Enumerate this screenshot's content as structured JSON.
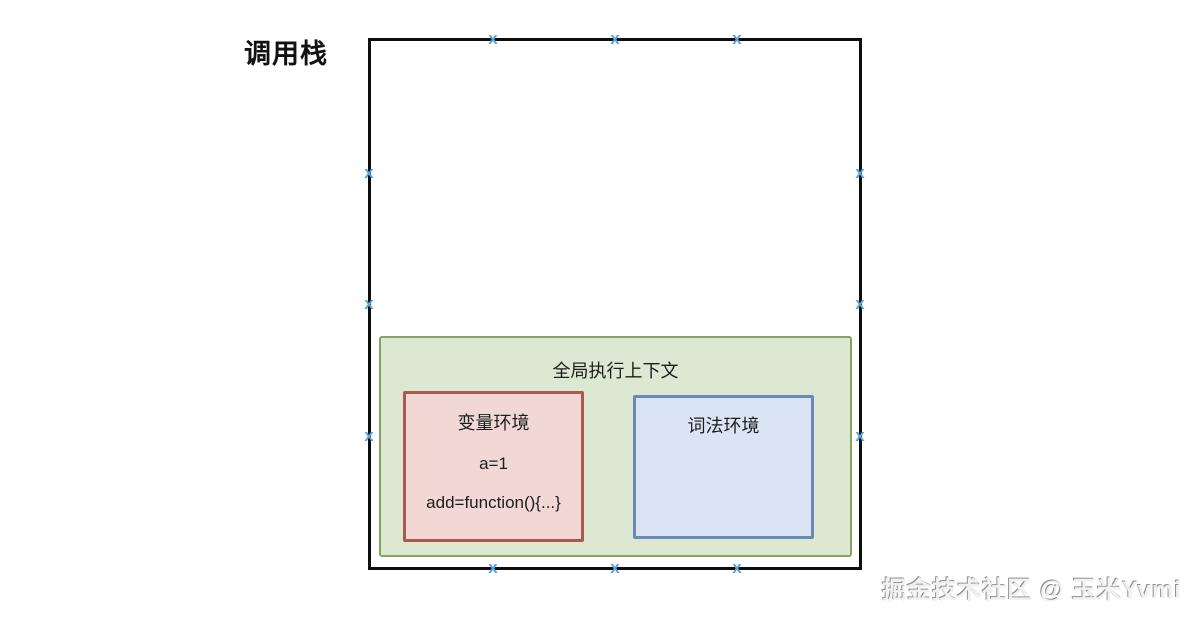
{
  "title": "调用栈",
  "diagram": {
    "call_stack": {
      "border_color": "#0d0d0d"
    },
    "global_context": {
      "label": "全局执行上下文",
      "fill": "#dde8d3",
      "border": "#85a35e",
      "variable_environment": {
        "label": "变量环境",
        "entries": [
          "a=1",
          "add=function(){...}"
        ],
        "fill": "#f2d8d5",
        "border": "#ab5752"
      },
      "lexical_environment": {
        "label": "词法环境",
        "fill": "#dbe4f4",
        "border": "#6c88b8"
      }
    }
  },
  "icons": {
    "connection_marker": "x",
    "marker_color": "#58a5dc"
  },
  "watermark": "掘金技术社区 @ 玉米Yvmi"
}
